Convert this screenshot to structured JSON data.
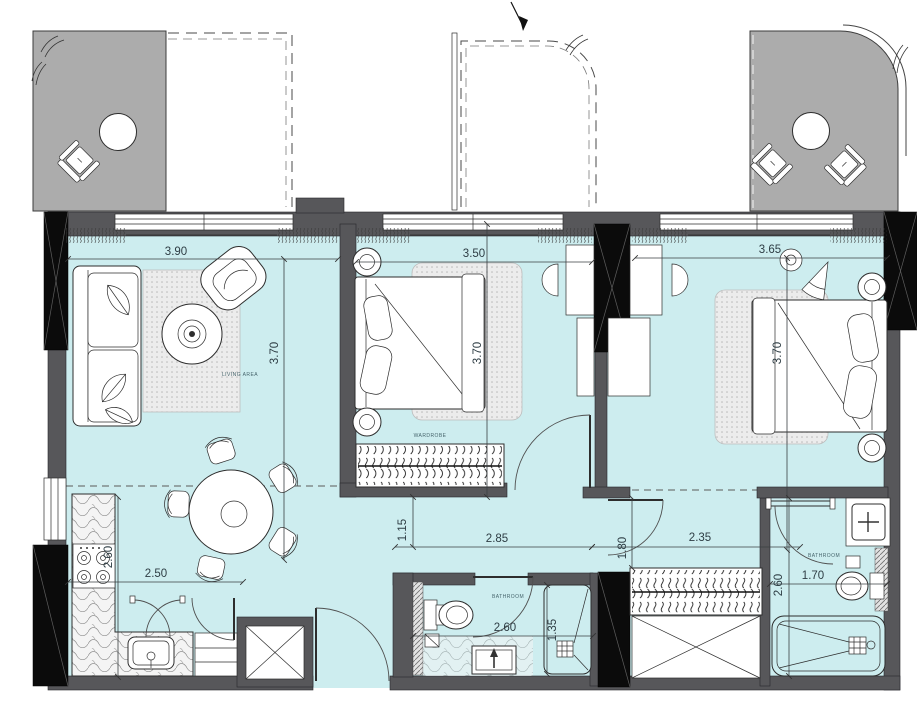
{
  "plan_labels": {
    "living_area": "LIVING AREA",
    "wardrobe": "WARDROBE",
    "bathroom_main": "BATHROOM",
    "bathroom_ensuite": "BATHROOM"
  },
  "dimensions": {
    "living_width": "3.90",
    "living_depth": "3.70",
    "bedroom1_width": "3.50",
    "bedroom1_depth": "3.70",
    "bedroom2_width": "3.65",
    "bedroom2_depth": "3.70",
    "kitchen_width": "2.50",
    "kitchen_depth": "2.60",
    "hall_offset": "1.15",
    "hall_width": "2.85",
    "bedroom2_opening": "1.80",
    "bedroom2_lobby_width": "2.35",
    "bathroom_main_width": "2.60",
    "shower_width": "1.35",
    "bathroom_ensuite_width": "1.70",
    "bathroom_ensuite_depth": "2.60"
  },
  "colors": {
    "floor": "#cdedef",
    "balcony": "#acacac",
    "wall": "#57575a",
    "column": "#0b0b0b",
    "outline": "#2d2d2d",
    "dim_text": "#2e3d44"
  }
}
